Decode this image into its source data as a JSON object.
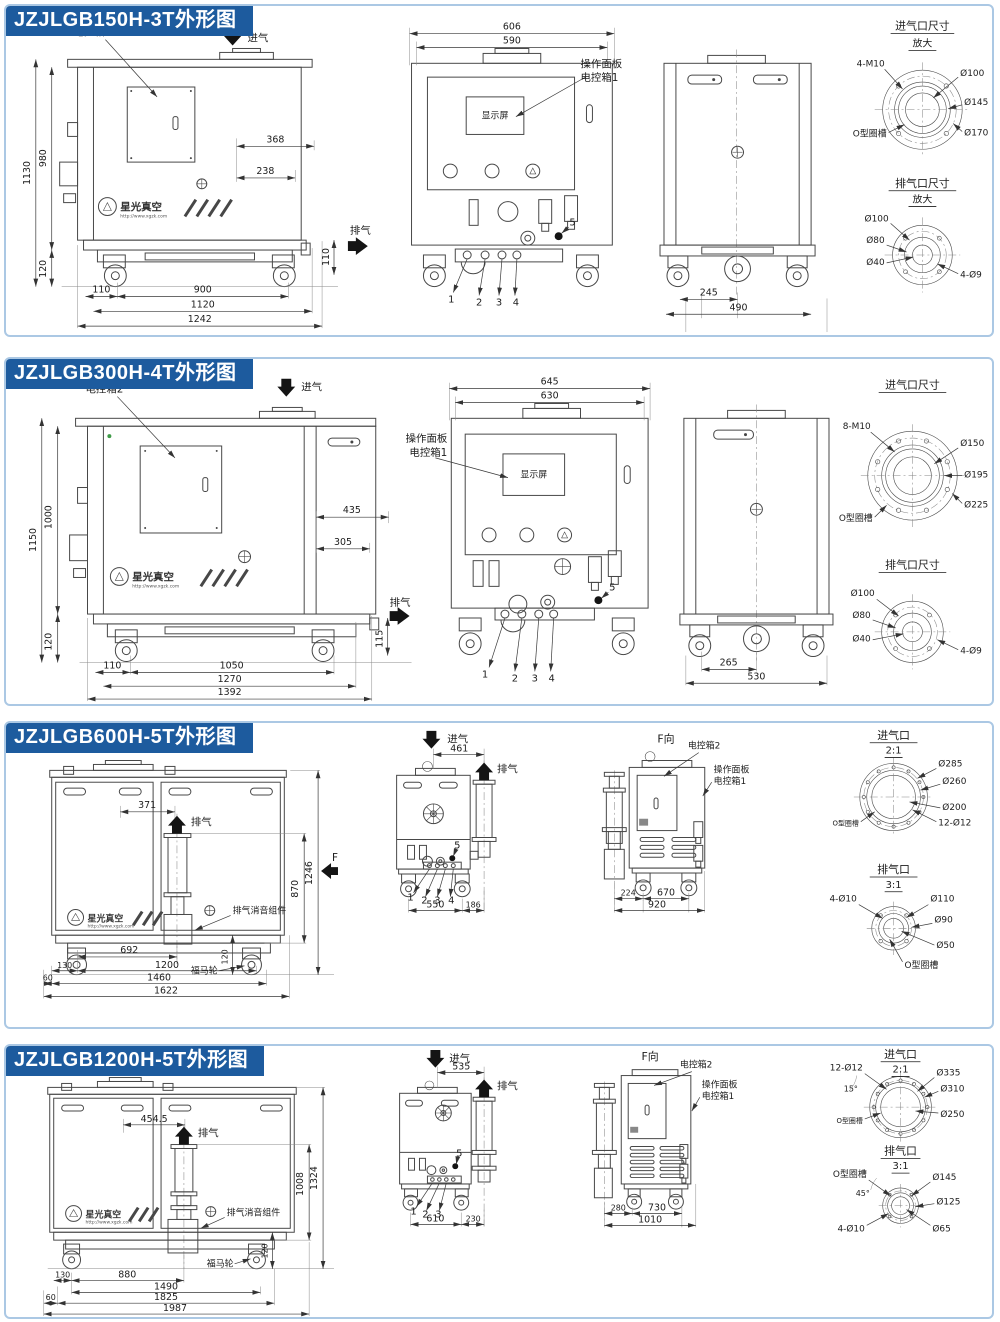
{
  "colors": {
    "title_bg": "#1d5b9e",
    "title_fg": "#ffffff",
    "panel_border": "#abc8e4",
    "line": "#474747",
    "green_dot": "#3f9b48"
  },
  "brand": {
    "name": "星光真空",
    "url": "http://www.xgzk.com"
  },
  "labels": {
    "inlet": "进气",
    "outlet": "排气",
    "ebox2": "电控箱2",
    "op_panel": "操作面板",
    "ebox1": "电控箱1",
    "display": "显示屏",
    "oring": "O型圈槽",
    "muffler": "排气消音组件",
    "caster": "福马轮",
    "f": "F",
    "f_view": "F向",
    "c1": "1",
    "c2": "2",
    "c3": "3",
    "c4": "4",
    "c5": "5"
  },
  "panels": [
    {
      "title": "JZJLGB150H-3T外形图",
      "left_dims": {
        "total_h": "1130",
        "body_h": "980",
        "base_h": "120",
        "top_w": "368",
        "top_w2": "238",
        "right_h": "110",
        "off": "110",
        "span": "900",
        "mid": "1120",
        "total_w": "1242"
      },
      "front_dims": {
        "w1": "606",
        "w2": "590"
      },
      "side_dims": {
        "w1": "245",
        "w2": "490"
      },
      "inlet_detail": {
        "title": "进气口尺寸",
        "sub": "放大",
        "bolts": "4-M10",
        "d1": "Ø100",
        "d2": "Ø145",
        "d3": "Ø170"
      },
      "outlet_detail": {
        "title": "排气口尺寸",
        "sub": "放大",
        "d1": "Ø100",
        "d2": "Ø80",
        "d3": "Ø40",
        "bolts": "4-Ø9"
      }
    },
    {
      "title": "JZJLGB300H-4T外形图",
      "left_dims": {
        "total_h": "1150",
        "body_h": "1000",
        "base_h": "120",
        "top_w": "435",
        "top_w2": "305",
        "right_h": "115",
        "off": "110",
        "span": "1050",
        "mid": "1270",
        "total_w": "1392"
      },
      "front_dims": {
        "w1": "645",
        "w2": "630"
      },
      "side_dims": {
        "w1": "265",
        "w2": "530"
      },
      "inlet_detail": {
        "title": "进气口尺寸",
        "bolts": "8-M10",
        "d1": "Ø150",
        "d2": "Ø195",
        "d3": "Ø225"
      },
      "outlet_detail": {
        "title": "排气口尺寸",
        "d1": "Ø100",
        "d2": "Ø80",
        "d3": "Ø40",
        "bolts": "4-Ø9"
      }
    },
    {
      "title": "JZJLGB600H-5T外形图",
      "left_dims": {
        "offset": "371",
        "muffler_h": "870",
        "total_h": "1246",
        "base_h": "120",
        "off": "130",
        "span1": "692",
        "span2": "1200",
        "off2": "60",
        "mid": "1460",
        "total_w": "1622"
      },
      "front_dims": {
        "top": "461",
        "w1": "550",
        "w2": "186"
      },
      "fview_dims": {
        "w1": "224",
        "w2": "670",
        "w3": "920"
      },
      "inlet_detail": {
        "title": "进气口",
        "sub": "2:1",
        "d1": "Ø285",
        "d2": "Ø260",
        "d3": "Ø200",
        "bolts": "12-Ø12"
      },
      "outlet_detail": {
        "title": "排气口",
        "sub": "3:1",
        "bolts": "4-Ø10",
        "d1": "Ø110",
        "d2": "Ø90",
        "d3": "Ø50"
      }
    },
    {
      "title": "JZJLGB1200H-5T外形图",
      "left_dims": {
        "offset": "454.5",
        "muffler_h": "1008",
        "total_h": "1324",
        "base_h": "120",
        "off": "130",
        "span1": "880",
        "span2": "1490",
        "mid": "1825",
        "off2": "60",
        "total_w": "1987"
      },
      "front_dims": {
        "top": "535",
        "w1": "610",
        "w2": "230"
      },
      "fview_dims": {
        "w1": "280",
        "w2": "730",
        "w3": "1010"
      },
      "inlet_detail": {
        "title": "进气口",
        "sub": "2:1",
        "bolts": "12-Ø12",
        "angle": "15°",
        "d1": "Ø335",
        "d2": "Ø310",
        "d3": "Ø250"
      },
      "outlet_detail": {
        "title": "排气口",
        "sub": "3:1",
        "angle": "45°",
        "d1": "Ø145",
        "d2": "Ø125",
        "d3": "Ø65",
        "bolts": "4-Ø10"
      }
    }
  ]
}
